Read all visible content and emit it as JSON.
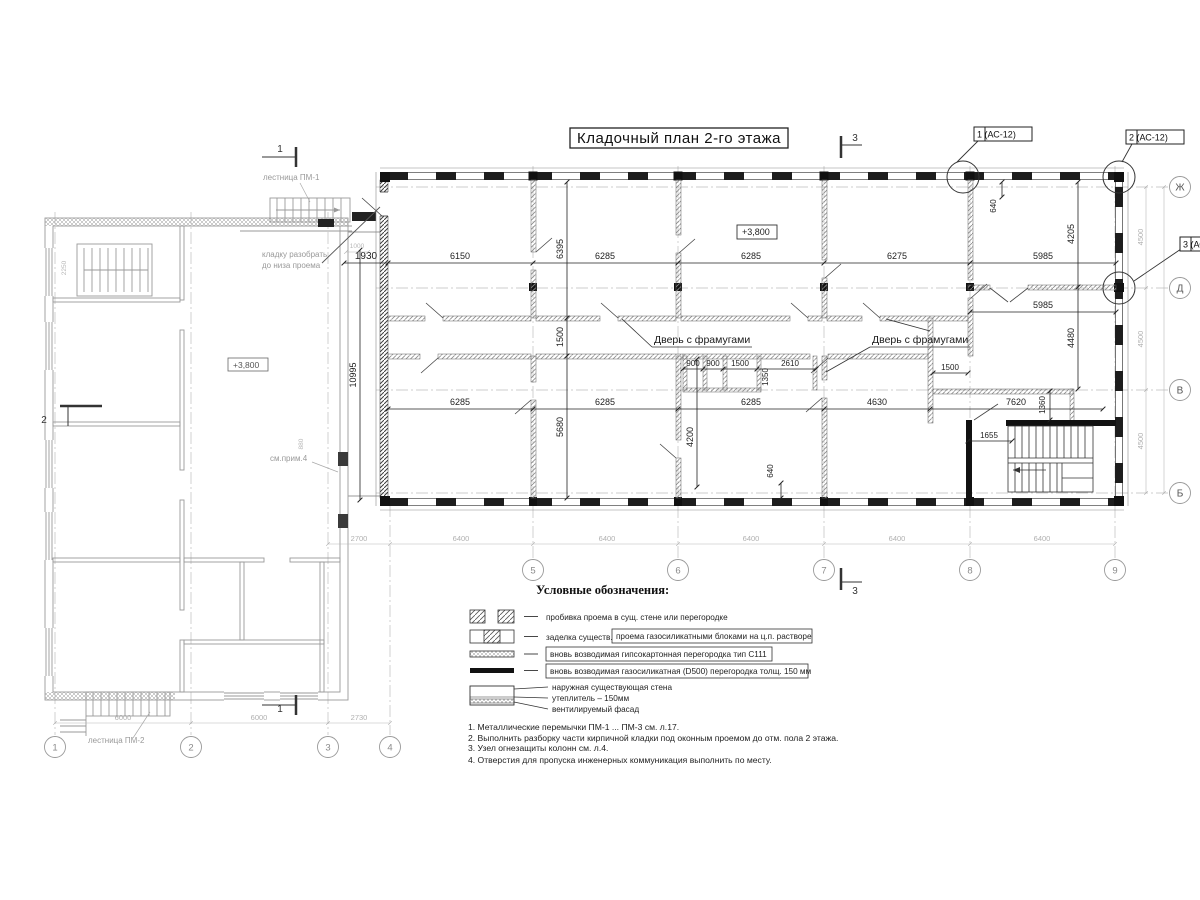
{
  "title": "Кладочный план 2-го этажа",
  "callouts": {
    "c1": "1 (АС-12)",
    "c2": "2 (АС-12)",
    "c3": "3 (АС-12)"
  },
  "elev": {
    "main": "+3,800",
    "old": "+3,800"
  },
  "axes": {
    "a1": "1",
    "a2": "2",
    "a3": "3",
    "a4": "4",
    "a5": "5",
    "a6": "6",
    "a7": "7",
    "a8": "8",
    "a9": "9",
    "zh": "Ж",
    "d": "Д",
    "v": "В",
    "b": "Б"
  },
  "sections": {
    "s1top": "1",
    "s1bot": "1",
    "s2": "2",
    "s3top": "3",
    "s3bot": "3"
  },
  "dims": {
    "top": [
      "1930",
      "6150",
      "6285",
      "6285",
      "6275",
      "5985"
    ],
    "room5985": "5985",
    "mid": [
      "6285",
      "6285",
      "6285",
      "4630",
      "7620"
    ],
    "small": [
      "900",
      "900",
      "1500",
      "2610"
    ],
    "d1350": "1350",
    "d1360": "1360",
    "d1500": "1500",
    "d1655": "1655",
    "v6395": "6395",
    "v1500": "1500",
    "v5680": "5680",
    "v4200": "4200",
    "v10995": "10995",
    "v4205": "4205",
    "v4480": "4480",
    "v640t": "640",
    "v640b": "640",
    "grayBottom": [
      "2700",
      "6400",
      "6400",
      "6400",
      "6400",
      "6400"
    ],
    "grayLeft": [
      "6000",
      "6000",
      "2730"
    ],
    "grayRight": [
      "4500",
      "4500",
      "4500"
    ],
    "g1000": "1000",
    "g2250": "2250",
    "g880": "880"
  },
  "labels": {
    "door1": "Дверь с фрамугами",
    "door2": "Дверь с фрамугами",
    "stair1": "лестница ПМ-1",
    "stair2": "лестница ПМ-2",
    "demol1": "кладку разобрать",
    "demol2": "до низа проема",
    "note4": "см.прим.4"
  },
  "legend": {
    "heading": "Условные обозначения:",
    "r1": "пробивка проема  в сущ. стене  или перегородке",
    "r2a": "заделка существ.",
    "r2b": "проема газосиликатными блоками на ц.п. растворе",
    "r3": "вновь возводимая гипсокартонная перегородка тип С111",
    "r4": "вновь возводимая газосиликатная (D500) перегородка толщ. 150 мм",
    "r5a": "наружная существующая стена",
    "r5b": "утеплитель – 150мм",
    "r5c": "вентилируемый фасад"
  },
  "notes": [
    "1. Металлические перемычки  ПМ-1 ... ПМ-3  см. л.17.",
    "2. Выполнить разборку части кирпичной кладки под оконным проемом до отм. пола 2 этажа.",
    "3. Узел огнезащиты колонн см. л.4.",
    "4. Отверстия для пропуска инженерных коммуникация выполнить по месту."
  ]
}
